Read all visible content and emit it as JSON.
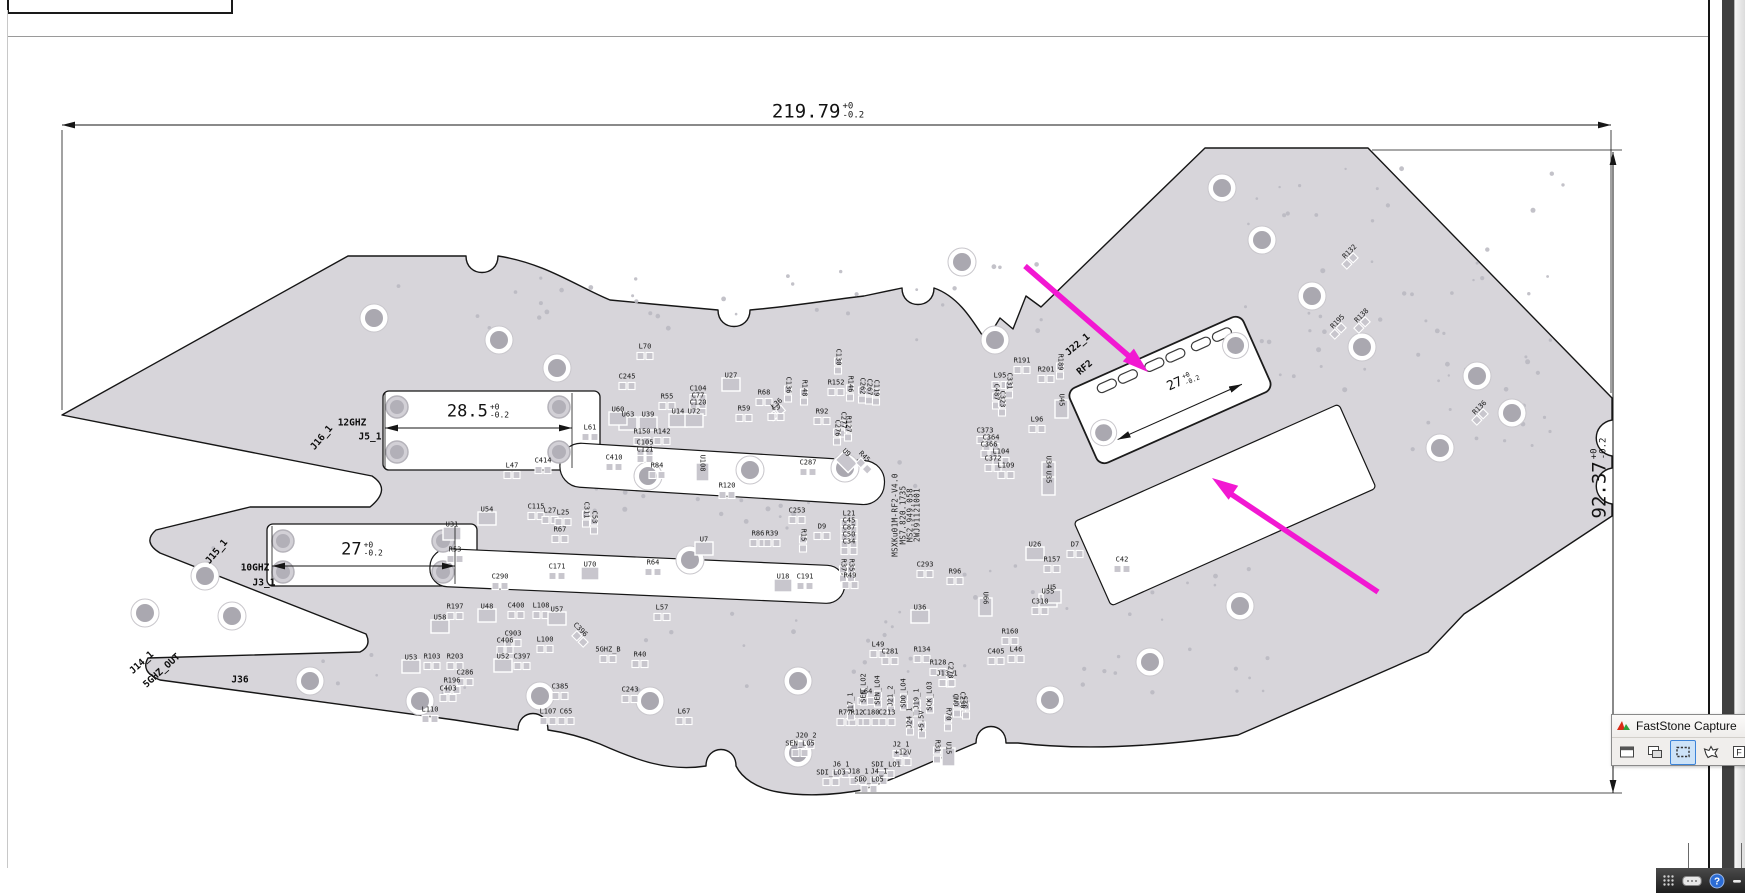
{
  "drawing": {
    "dimensions": {
      "board_width": {
        "value": "219.79",
        "tol_up": "+0",
        "tol_dn": "-0.2"
      },
      "board_height": {
        "value": "92.37",
        "tol_up": "+0",
        "tol_dn": "-0.2"
      },
      "slot_top": {
        "value": "28.5",
        "tol_up": "+0",
        "tol_dn": "-0.2"
      },
      "slot_bottom": {
        "value": "27",
        "tol_up": "+0",
        "tol_dn": "-0.2"
      },
      "module": {
        "value": "27",
        "tol_up": "+0",
        "tol_dn": "-0.2"
      }
    },
    "part_numbers": [
      {
        "t": "MSXKu01M-RF2-V4.0",
        "x": 895,
        "y": 515,
        "r": -90
      },
      {
        "t": "MS7.820.1735",
        "x": 903,
        "y": 515,
        "r": -90
      },
      {
        "t": "MS2.949.058",
        "x": 910,
        "y": 515,
        "r": -90
      },
      {
        "t": "2WJ91121001",
        "x": 917,
        "y": 515,
        "r": -90
      }
    ],
    "ports": [
      {
        "t": "12GHZ",
        "x": 352,
        "y": 423
      },
      {
        "t": "J5_1",
        "x": 370,
        "y": 437
      },
      {
        "t": "J16_1",
        "x": 322,
        "y": 438,
        "r": -50
      },
      {
        "t": "10GHZ",
        "x": 255,
        "y": 568
      },
      {
        "t": "J3_1",
        "x": 264,
        "y": 583
      },
      {
        "t": "J15_1",
        "x": 217,
        "y": 552,
        "r": -50
      },
      {
        "t": "J14_1",
        "x": 142,
        "y": 663,
        "r": -42
      },
      {
        "t": "5GHZ_OUT",
        "x": 162,
        "y": 671,
        "r": -42
      },
      {
        "t": "J22_1",
        "x": 1078,
        "y": 345,
        "r": -40
      },
      {
        "t": "RF2",
        "x": 1085,
        "y": 368,
        "r": -40
      },
      {
        "t": "J36",
        "x": 240,
        "y": 680
      }
    ],
    "components": [
      {
        "t": "L70",
        "x": 645,
        "y": 347
      },
      {
        "t": "C245",
        "x": 627,
        "y": 377
      },
      {
        "t": "U27",
        "x": 731,
        "y": 376
      },
      {
        "t": "C104",
        "x": 698,
        "y": 389
      },
      {
        "t": "C77",
        "x": 698,
        "y": 396
      },
      {
        "t": "C120",
        "x": 698,
        "y": 403
      },
      {
        "t": "U63",
        "x": 628,
        "y": 415
      },
      {
        "t": "U39",
        "x": 648,
        "y": 415
      },
      {
        "t": "R59",
        "x": 744,
        "y": 409
      },
      {
        "t": "R68",
        "x": 764,
        "y": 393
      },
      {
        "t": "L36",
        "x": 777,
        "y": 404,
        "r": -40
      },
      {
        "t": "C136",
        "x": 788,
        "y": 385,
        "r": 90
      },
      {
        "t": "R148",
        "x": 804,
        "y": 388,
        "r": 90
      },
      {
        "t": "R152",
        "x": 836,
        "y": 383
      },
      {
        "t": "R146",
        "x": 850,
        "y": 384,
        "r": 90
      },
      {
        "t": "C262",
        "x": 862,
        "y": 386,
        "r": 90
      },
      {
        "t": "C267",
        "x": 869,
        "y": 387,
        "r": 90
      },
      {
        "t": "C119",
        "x": 876,
        "y": 388,
        "r": 90
      },
      {
        "t": "C105",
        "x": 645,
        "y": 443
      },
      {
        "t": "C121",
        "x": 645,
        "y": 450
      },
      {
        "t": "R92",
        "x": 822,
        "y": 412
      },
      {
        "t": "C277",
        "x": 843,
        "y": 420,
        "r": 90
      },
      {
        "t": "C276",
        "x": 837,
        "y": 428,
        "r": 90
      },
      {
        "t": "R127",
        "x": 848,
        "y": 424,
        "r": 90
      },
      {
        "t": "C130",
        "x": 838,
        "y": 357,
        "r": 90
      },
      {
        "t": "R55",
        "x": 667,
        "y": 397
      },
      {
        "t": "U60",
        "x": 618,
        "y": 410
      },
      {
        "t": "U14",
        "x": 678,
        "y": 412
      },
      {
        "t": "U72",
        "x": 694,
        "y": 412
      },
      {
        "t": "L61",
        "x": 590,
        "y": 428
      },
      {
        "t": "R150",
        "x": 642,
        "y": 432
      },
      {
        "t": "R142",
        "x": 662,
        "y": 432
      },
      {
        "t": "L9",
        "x": 776,
        "y": 408
      },
      {
        "t": "L47",
        "x": 512,
        "y": 466
      },
      {
        "t": "C414",
        "x": 543,
        "y": 461
      },
      {
        "t": "C410",
        "x": 614,
        "y": 458
      },
      {
        "t": "R84",
        "x": 657,
        "y": 466
      },
      {
        "t": "U108",
        "x": 702,
        "y": 463,
        "r": 90
      },
      {
        "t": "R120",
        "x": 727,
        "y": 486
      },
      {
        "t": "C253",
        "x": 797,
        "y": 511
      },
      {
        "t": "D9",
        "x": 822,
        "y": 527
      },
      {
        "t": "R15",
        "x": 803,
        "y": 535,
        "r": 90
      },
      {
        "t": "L21",
        "x": 849,
        "y": 514
      },
      {
        "t": "C45",
        "x": 849,
        "y": 521
      },
      {
        "t": "C87",
        "x": 849,
        "y": 528
      },
      {
        "t": "C50",
        "x": 849,
        "y": 535
      },
      {
        "t": "C34",
        "x": 849,
        "y": 542
      },
      {
        "t": "R37",
        "x": 843,
        "y": 565,
        "r": 90
      },
      {
        "t": "R35",
        "x": 851,
        "y": 565,
        "r": 90
      },
      {
        "t": "R49",
        "x": 850,
        "y": 576
      },
      {
        "t": "U31",
        "x": 452,
        "y": 525
      },
      {
        "t": "R53",
        "x": 455,
        "y": 550
      },
      {
        "t": "U54",
        "x": 487,
        "y": 510
      },
      {
        "t": "C115",
        "x": 536,
        "y": 507
      },
      {
        "t": "L27",
        "x": 550,
        "y": 511
      },
      {
        "t": "L25",
        "x": 563,
        "y": 513
      },
      {
        "t": "C311",
        "x": 586,
        "y": 510,
        "r": 90
      },
      {
        "t": "C53",
        "x": 594,
        "y": 517,
        "r": 90
      },
      {
        "t": "U70",
        "x": 590,
        "y": 565
      },
      {
        "t": "C171",
        "x": 557,
        "y": 567
      },
      {
        "t": "C290",
        "x": 500,
        "y": 577
      },
      {
        "t": "R67",
        "x": 560,
        "y": 530
      },
      {
        "t": "U7",
        "x": 704,
        "y": 540
      },
      {
        "t": "R86",
        "x": 758,
        "y": 534
      },
      {
        "t": "R39",
        "x": 772,
        "y": 534
      },
      {
        "t": "U18",
        "x": 783,
        "y": 577
      },
      {
        "t": "C191",
        "x": 805,
        "y": 577
      },
      {
        "t": "R64",
        "x": 653,
        "y": 563
      },
      {
        "t": "C287",
        "x": 808,
        "y": 463
      },
      {
        "t": "U9",
        "x": 846,
        "y": 453,
        "r": 45
      },
      {
        "t": "R45",
        "x": 864,
        "y": 457,
        "r": 45
      },
      {
        "t": "R191",
        "x": 1022,
        "y": 361
      },
      {
        "t": "R201",
        "x": 1046,
        "y": 370
      },
      {
        "t": "R189",
        "x": 1060,
        "y": 362,
        "r": 90
      },
      {
        "t": "L95",
        "x": 1000,
        "y": 376
      },
      {
        "t": "C331",
        "x": 1009,
        "y": 381,
        "r": 90
      },
      {
        "t": "C487",
        "x": 996,
        "y": 392,
        "r": 90
      },
      {
        "t": "C323",
        "x": 1002,
        "y": 399,
        "r": 90
      },
      {
        "t": "U45",
        "x": 1061,
        "y": 400,
        "r": 90
      },
      {
        "t": "L96",
        "x": 1037,
        "y": 420
      },
      {
        "t": "C373",
        "x": 985,
        "y": 431
      },
      {
        "t": "C364",
        "x": 991,
        "y": 438
      },
      {
        "t": "C366",
        "x": 989,
        "y": 445
      },
      {
        "t": "L104",
        "x": 1001,
        "y": 452
      },
      {
        "t": "C372",
        "x": 993,
        "y": 459
      },
      {
        "t": "L109",
        "x": 1006,
        "y": 466
      },
      {
        "t": "U34",
        "x": 1048,
        "y": 462,
        "r": 90
      },
      {
        "t": "U35",
        "x": 1048,
        "y": 477,
        "r": 90
      },
      {
        "t": "R132",
        "x": 1350,
        "y": 252,
        "r": -45
      },
      {
        "t": "R138",
        "x": 1362,
        "y": 316,
        "r": -45
      },
      {
        "t": "R195",
        "x": 1338,
        "y": 322,
        "r": -45
      },
      {
        "t": "R136",
        "x": 1480,
        "y": 408,
        "r": -45
      },
      {
        "t": "C293",
        "x": 925,
        "y": 565
      },
      {
        "t": "R96",
        "x": 955,
        "y": 572
      },
      {
        "t": "U66",
        "x": 985,
        "y": 598,
        "r": 90
      },
      {
        "t": "U55",
        "x": 1048,
        "y": 592
      },
      {
        "t": "C310",
        "x": 1040,
        "y": 602
      },
      {
        "t": "L49",
        "x": 878,
        "y": 645
      },
      {
        "t": "C281",
        "x": 890,
        "y": 652
      },
      {
        "t": "R134",
        "x": 922,
        "y": 650
      },
      {
        "t": "R128",
        "x": 938,
        "y": 663
      },
      {
        "t": "C278",
        "x": 950,
        "y": 670,
        "r": 90
      },
      {
        "t": "U36",
        "x": 920,
        "y": 608
      },
      {
        "t": "L64",
        "x": 866,
        "y": 692
      },
      {
        "t": "R77",
        "x": 845,
        "y": 713
      },
      {
        "t": "R12",
        "x": 857,
        "y": 713
      },
      {
        "t": "C180",
        "x": 871,
        "y": 713
      },
      {
        "t": "C213",
        "x": 887,
        "y": 713
      },
      {
        "t": "U26",
        "x": 1035,
        "y": 545
      },
      {
        "t": "D7",
        "x": 1075,
        "y": 545
      },
      {
        "t": "R157",
        "x": 1052,
        "y": 560
      },
      {
        "t": "C42",
        "x": 1122,
        "y": 560
      },
      {
        "t": "U5",
        "x": 1052,
        "y": 588
      },
      {
        "t": "R160",
        "x": 1010,
        "y": 632
      },
      {
        "t": "L46",
        "x": 1016,
        "y": 650
      },
      {
        "t": "C405",
        "x": 996,
        "y": 652
      },
      {
        "t": "R70",
        "x": 948,
        "y": 714,
        "r": 90
      },
      {
        "t": "C230",
        "x": 962,
        "y": 700,
        "r": 90
      },
      {
        "t": "R31",
        "x": 937,
        "y": 746,
        "r": 90
      },
      {
        "t": "U15",
        "x": 948,
        "y": 748,
        "r": 90
      },
      {
        "t": "J17_1",
        "x": 851,
        "y": 703,
        "r": -90
      },
      {
        "t": "SEN_LO2",
        "x": 864,
        "y": 688,
        "r": -90
      },
      {
        "t": "SEN_LO4",
        "x": 878,
        "y": 690,
        "r": -90
      },
      {
        "t": "J21_2",
        "x": 891,
        "y": 696,
        "r": -90
      },
      {
        "t": "SDO_LO4",
        "x": 904,
        "y": 693,
        "r": -90
      },
      {
        "t": "J19_1",
        "x": 917,
        "y": 699,
        "r": -90
      },
      {
        "t": "SCK_LO3",
        "x": 930,
        "y": 696,
        "r": -90
      },
      {
        "t": "J13_1",
        "x": 947,
        "y": 674
      },
      {
        "t": "GND",
        "x": 957,
        "y": 700,
        "r": -90
      },
      {
        "t": "J25",
        "x": 966,
        "y": 702,
        "r": -90
      },
      {
        "t": "J24_1",
        "x": 910,
        "y": 718,
        "r": -90
      },
      {
        "t": "+5.5V",
        "x": 922,
        "y": 721,
        "r": -90
      },
      {
        "t": "J20_2",
        "x": 806,
        "y": 736
      },
      {
        "t": "SEN_LO5",
        "x": 800,
        "y": 744
      },
      {
        "t": "J2_1",
        "x": 901,
        "y": 745
      },
      {
        "t": "+12V",
        "x": 903,
        "y": 753
      },
      {
        "t": "J6_1",
        "x": 841,
        "y": 765
      },
      {
        "t": "SDI_LO1",
        "x": 886,
        "y": 765
      },
      {
        "t": "SDI_LO3",
        "x": 831,
        "y": 773
      },
      {
        "t": "J18_1",
        "x": 858,
        "y": 772
      },
      {
        "t": "J4_1",
        "x": 879,
        "y": 772
      },
      {
        "t": "SDO_LO5",
        "x": 869,
        "y": 780
      },
      {
        "t": "R197",
        "x": 455,
        "y": 607
      },
      {
        "t": "U48",
        "x": 487,
        "y": 607
      },
      {
        "t": "C400",
        "x": 516,
        "y": 606
      },
      {
        "t": "L108",
        "x": 541,
        "y": 606
      },
      {
        "t": "U57",
        "x": 557,
        "y": 610
      },
      {
        "t": "L57",
        "x": 662,
        "y": 608
      },
      {
        "t": "U58",
        "x": 440,
        "y": 618
      },
      {
        "t": "C903",
        "x": 513,
        "y": 634
      },
      {
        "t": "C406",
        "x": 505,
        "y": 641
      },
      {
        "t": "L100",
        "x": 545,
        "y": 640
      },
      {
        "t": "C396",
        "x": 580,
        "y": 630,
        "r": 45
      },
      {
        "t": "U53",
        "x": 411,
        "y": 658
      },
      {
        "t": "R103",
        "x": 432,
        "y": 657
      },
      {
        "t": "R203",
        "x": 455,
        "y": 657
      },
      {
        "t": "U52",
        "x": 503,
        "y": 657
      },
      {
        "t": "C397",
        "x": 522,
        "y": 657
      },
      {
        "t": "5GHZ_B",
        "x": 608,
        "y": 650
      },
      {
        "t": "R40",
        "x": 640,
        "y": 655
      },
      {
        "t": "C286",
        "x": 465,
        "y": 673
      },
      {
        "t": "R196",
        "x": 452,
        "y": 681
      },
      {
        "t": "C403",
        "x": 448,
        "y": 689
      },
      {
        "t": "L110",
        "x": 430,
        "y": 710
      },
      {
        "t": "C385",
        "x": 560,
        "y": 687
      },
      {
        "t": "L107",
        "x": 548,
        "y": 712
      },
      {
        "t": "C65",
        "x": 566,
        "y": 712
      },
      {
        "t": "C243",
        "x": 630,
        "y": 690
      },
      {
        "t": "L67",
        "x": 684,
        "y": 712
      }
    ],
    "holes": [
      [
        374,
        318
      ],
      [
        499,
        340
      ],
      [
        557,
        368
      ],
      [
        648,
        476
      ],
      [
        845,
        468
      ],
      [
        995,
        340
      ],
      [
        962,
        262
      ],
      [
        1222,
        188
      ],
      [
        1262,
        240
      ],
      [
        1312,
        296
      ],
      [
        1362,
        347
      ],
      [
        1477,
        376
      ],
      [
        1512,
        413
      ],
      [
        1440,
        448
      ],
      [
        145,
        613
      ],
      [
        205,
        576
      ],
      [
        232,
        616
      ],
      [
        310,
        681
      ],
      [
        420,
        701
      ],
      [
        540,
        696
      ],
      [
        650,
        701
      ],
      [
        798,
        681
      ],
      [
        798,
        753
      ],
      [
        1050,
        700
      ],
      [
        1150,
        662
      ],
      [
        1240,
        606
      ],
      [
        690,
        560
      ],
      [
        750,
        470
      ]
    ],
    "slot_holes": [
      [
        397,
        407
      ],
      [
        559,
        407
      ],
      [
        397,
        452
      ],
      [
        559,
        452
      ],
      [
        283,
        541
      ],
      [
        443,
        541
      ],
      [
        283,
        572
      ],
      [
        443,
        572
      ]
    ]
  },
  "faststone": {
    "title": "FastStone Capture",
    "logo_icon": "faststone-logo",
    "buttons": [
      {
        "icon": "capture-window-icon",
        "active": false
      },
      {
        "icon": "capture-object-icon",
        "active": false
      },
      {
        "icon": "capture-rectangle-icon",
        "active": true
      },
      {
        "icon": "capture-freehand-icon",
        "active": false
      },
      {
        "icon": "capture-fullscreen-icon",
        "active": false
      },
      {
        "icon": "capture-scrolling-icon",
        "active": false
      }
    ]
  },
  "taskbar": {
    "icons": [
      "app-grid-icon",
      "keyboard-icon",
      "help-icon",
      "minimize-icon"
    ]
  }
}
